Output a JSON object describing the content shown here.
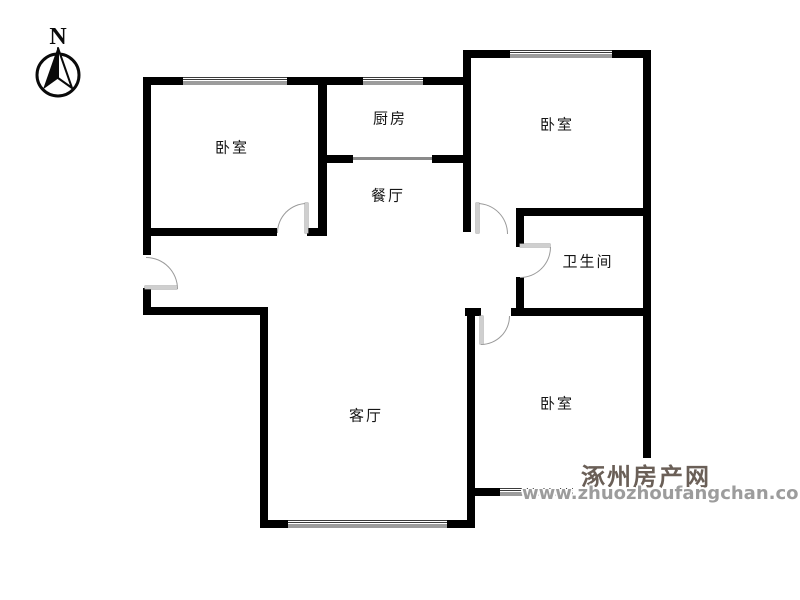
{
  "compass": {
    "north_label": "N"
  },
  "rooms": {
    "bedroom_top_left": {
      "label": "卧室"
    },
    "kitchen": {
      "label": "厨房"
    },
    "bedroom_top_right": {
      "label": "卧室"
    },
    "dining": {
      "label": "餐厅"
    },
    "bathroom": {
      "label": "卫生间"
    },
    "living": {
      "label": "客厅"
    },
    "bedroom_bottom_right": {
      "label": "卧室"
    }
  },
  "watermark": {
    "site_name": "涿州房产网",
    "site_url": "www.zhuozhoufangchan.com"
  },
  "colors": {
    "wall": "#000000",
    "door_arc": "#9a9a9a",
    "watermark_name": "#6a5f57",
    "watermark_url": "#9c9c9c",
    "background": "#ffffff"
  }
}
